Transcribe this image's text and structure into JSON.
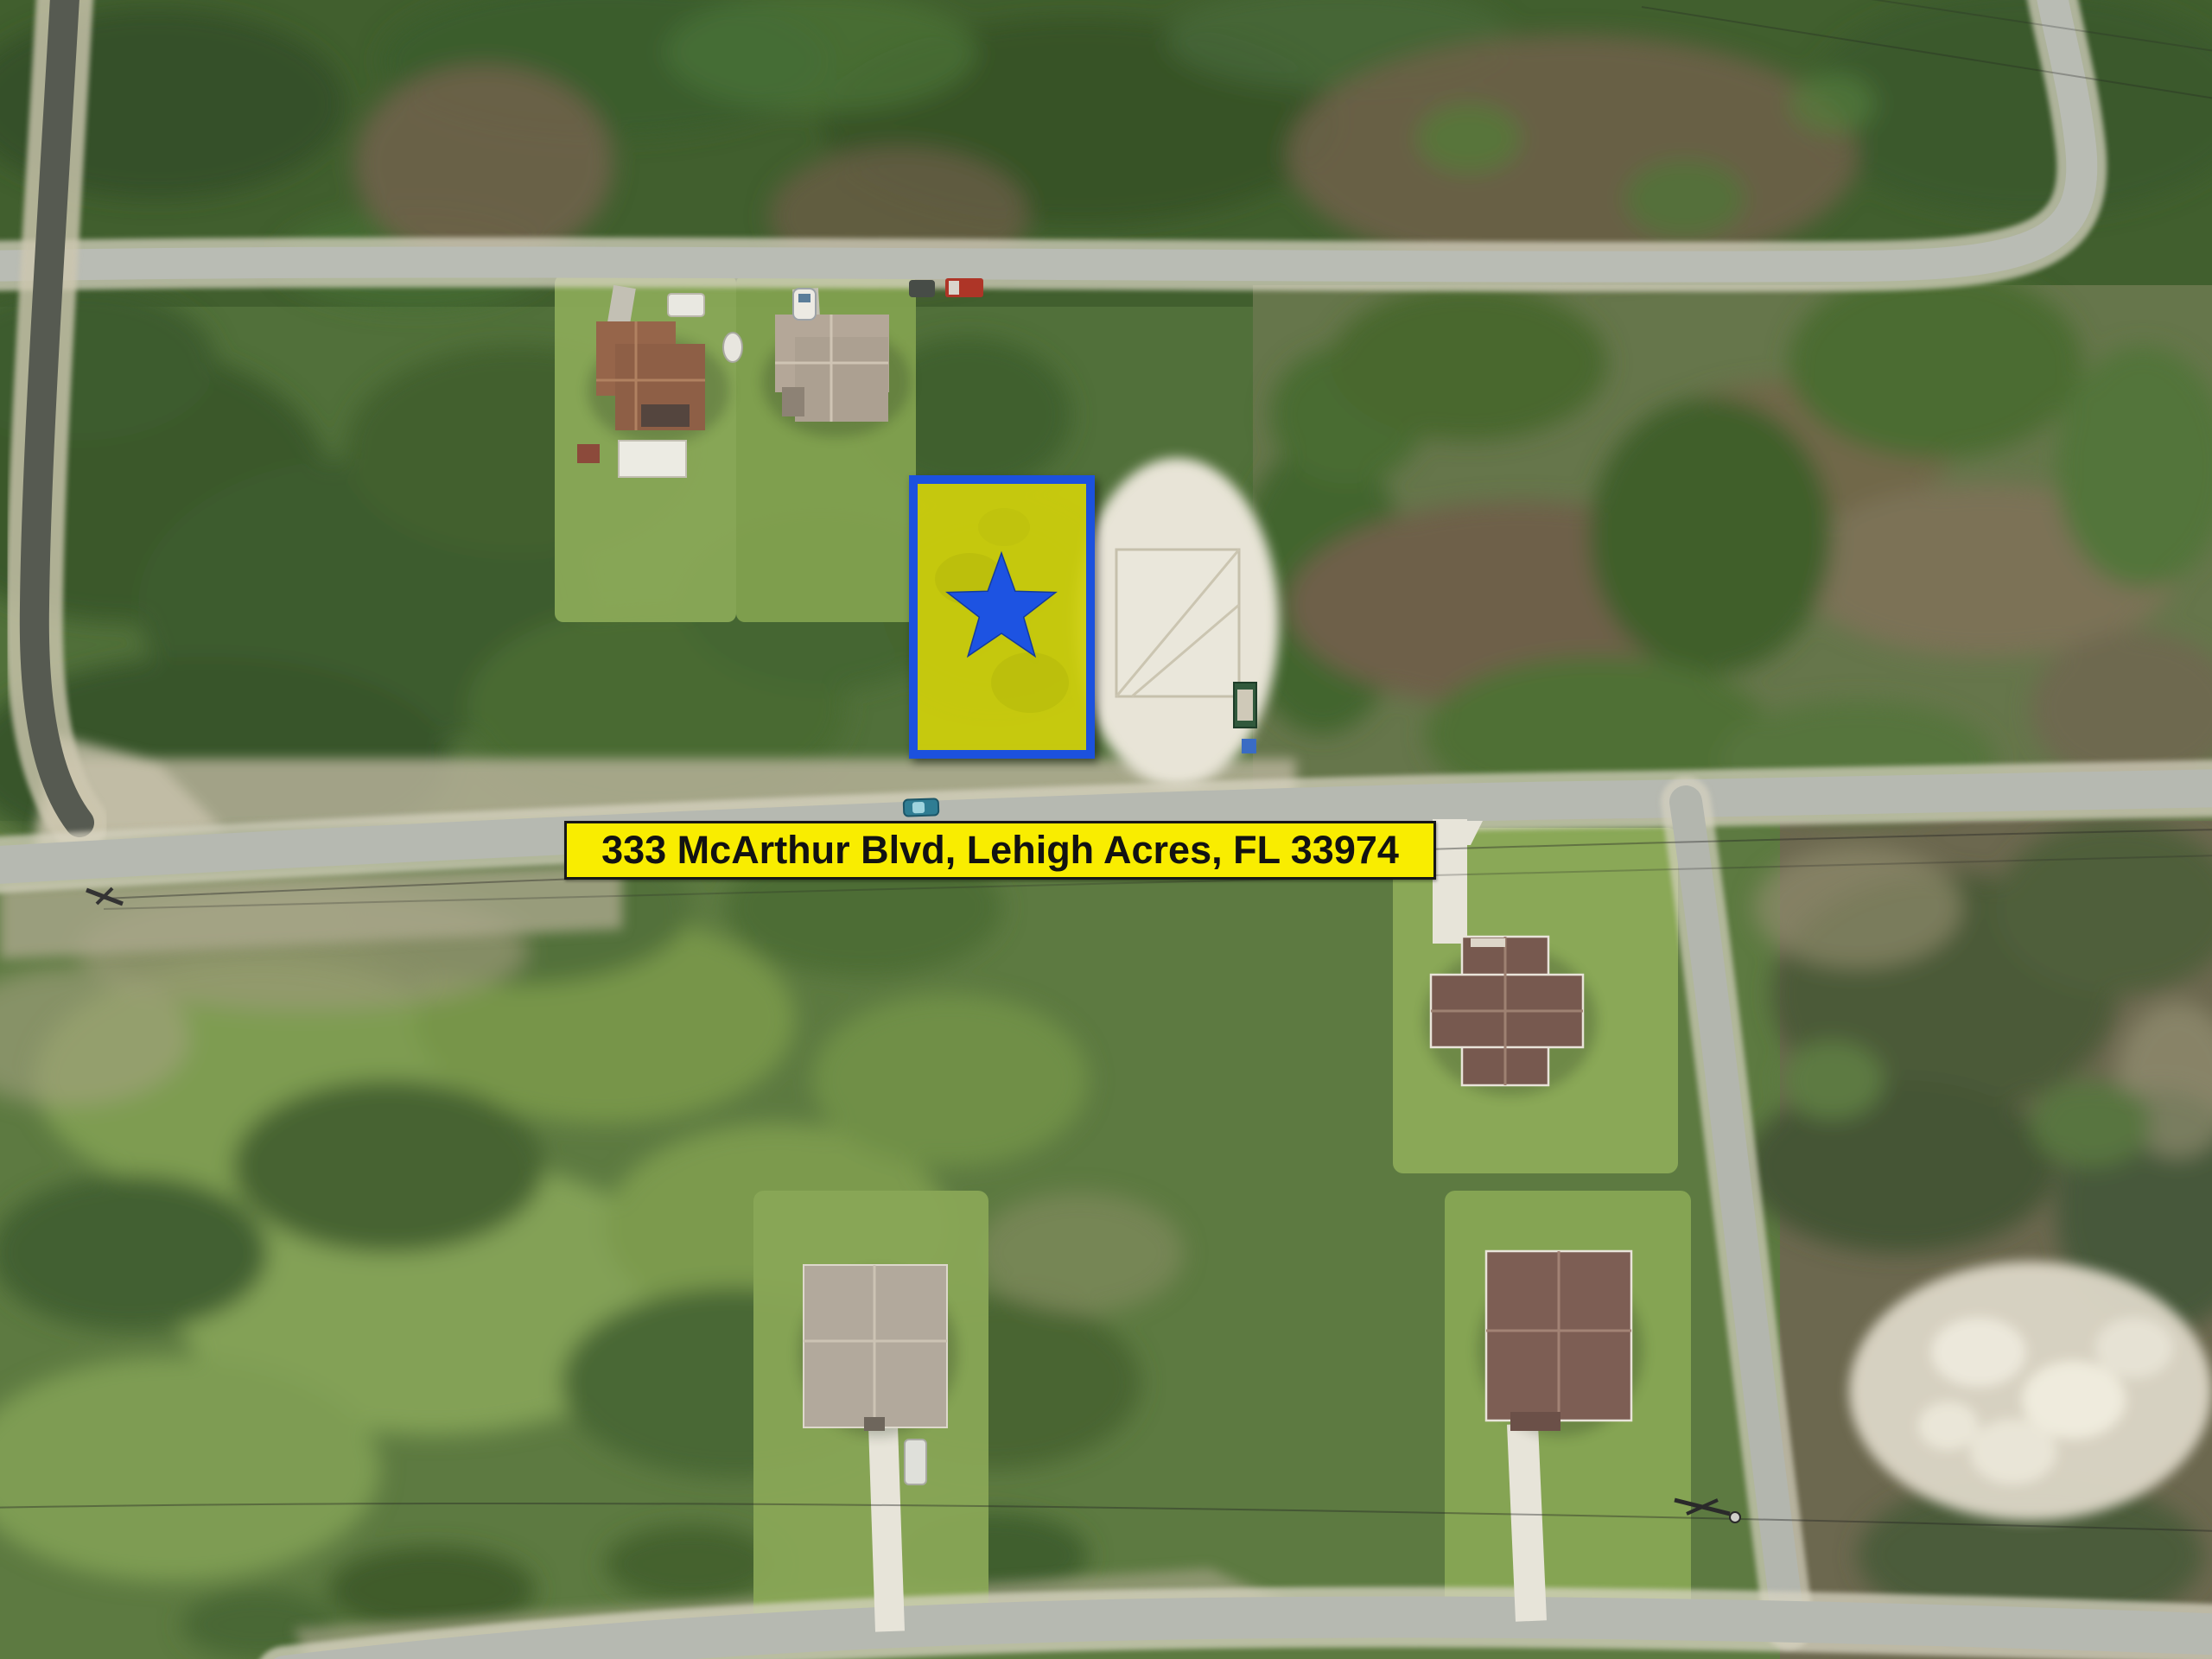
{
  "banner": {
    "text": "333 McArthur Blvd, Lehigh Acres, FL 33974",
    "background_color": "#F9ED00",
    "text_color": "#121212",
    "border_color": "#171717"
  },
  "highlight": {
    "fill_color": "#D6D70C",
    "fill_opacity": "0.9",
    "border_color": "#1C51DE",
    "star_color": "#1D53E2"
  },
  "icons": {
    "star_icon": "★"
  },
  "palette": {
    "forest_dark": "#3A572C",
    "forest_mid": "#4C6B35",
    "grass_lot": "#8AA957",
    "scrub_olive": "#66764B",
    "dirt_brown": "#6E6148",
    "sand_light": "#E7E3D6",
    "road_light": "#B7BAB2",
    "road_dark": "#565A51",
    "road_shoulder": "#D7D3C1",
    "roof_terracotta": "#96654A",
    "roof_tan": "#B4A798",
    "roof_brown": "#77594F"
  },
  "vehicles": {
    "car_on_road_color": "#2F7D93",
    "truck_color": "#AE3527",
    "white_car_color": "#DFE0DA"
  }
}
